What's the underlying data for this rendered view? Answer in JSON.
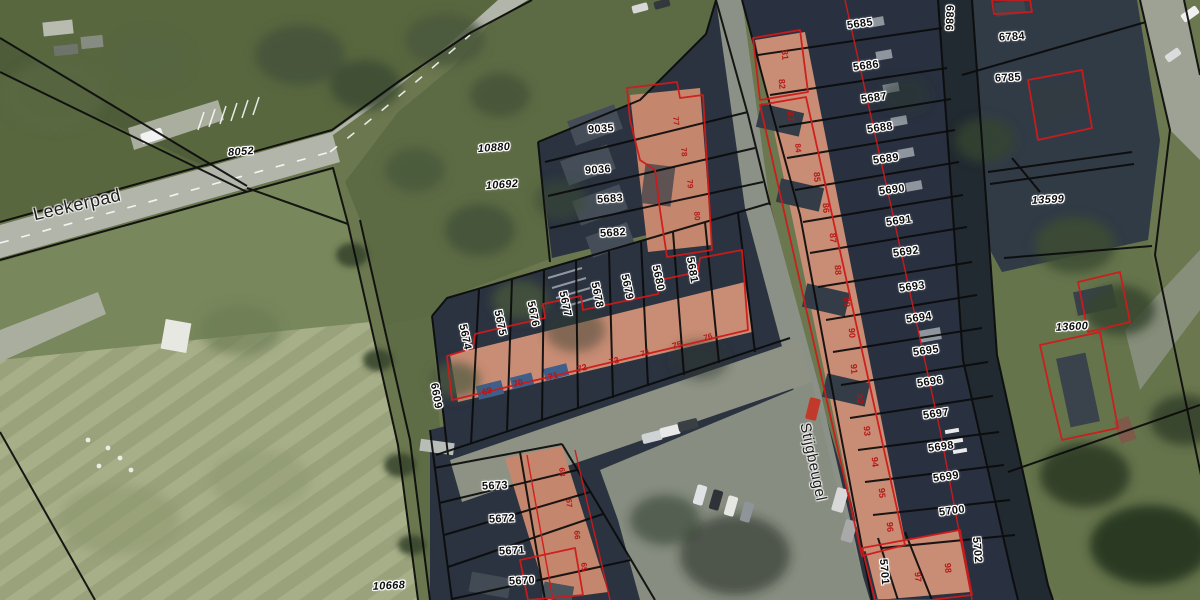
{
  "map": {
    "street_labels": [
      {
        "text": "Leekerpad",
        "x": 77,
        "y": 205,
        "rot": -13,
        "size": 18
      },
      {
        "text": "Stijgbeugel",
        "x": 813,
        "y": 462,
        "rot": 78,
        "size": 15
      }
    ],
    "parcel_labels": [
      {
        "text": "8052",
        "x": 241,
        "y": 152,
        "rot": -4,
        "italic": true
      },
      {
        "text": "10880",
        "x": 494,
        "y": 148,
        "rot": -4,
        "italic": true
      },
      {
        "text": "10692",
        "x": 502,
        "y": 185,
        "rot": -4,
        "italic": true
      },
      {
        "text": "10668",
        "x": 389,
        "y": 586,
        "rot": -3,
        "italic": true
      },
      {
        "text": "13599",
        "x": 1048,
        "y": 200,
        "rot": -3,
        "italic": true
      },
      {
        "text": "13600",
        "x": 1072,
        "y": 327,
        "rot": -3,
        "italic": true
      },
      {
        "text": "9035",
        "x": 601,
        "y": 129,
        "rot": -4
      },
      {
        "text": "9036",
        "x": 598,
        "y": 170,
        "rot": -4
      },
      {
        "text": "5683",
        "x": 610,
        "y": 199,
        "rot": -4
      },
      {
        "text": "5682",
        "x": 613,
        "y": 233,
        "rot": -4
      },
      {
        "text": "5685",
        "x": 860,
        "y": 24,
        "rot": -8
      },
      {
        "text": "5686",
        "x": 866,
        "y": 66,
        "rot": -8
      },
      {
        "text": "6886",
        "x": 949,
        "y": 18,
        "rot": 92
      },
      {
        "text": "6784",
        "x": 1012,
        "y": 37,
        "rot": -3
      },
      {
        "text": "6785",
        "x": 1008,
        "y": 78,
        "rot": -3
      },
      {
        "text": "5687",
        "x": 874,
        "y": 98,
        "rot": -8
      },
      {
        "text": "5688",
        "x": 880,
        "y": 128,
        "rot": -8
      },
      {
        "text": "5689",
        "x": 886,
        "y": 159,
        "rot": -8
      },
      {
        "text": "5690",
        "x": 892,
        "y": 190,
        "rot": -8
      },
      {
        "text": "5691",
        "x": 899,
        "y": 221,
        "rot": -8
      },
      {
        "text": "5692",
        "x": 906,
        "y": 252,
        "rot": -8
      },
      {
        "text": "5693",
        "x": 912,
        "y": 287,
        "rot": -8
      },
      {
        "text": "5694",
        "x": 919,
        "y": 318,
        "rot": -8
      },
      {
        "text": "5695",
        "x": 926,
        "y": 351,
        "rot": -8
      },
      {
        "text": "5696",
        "x": 930,
        "y": 382,
        "rot": -8
      },
      {
        "text": "5697",
        "x": 936,
        "y": 414,
        "rot": -8
      },
      {
        "text": "5698",
        "x": 941,
        "y": 447,
        "rot": -8
      },
      {
        "text": "5699",
        "x": 946,
        "y": 477,
        "rot": -8
      },
      {
        "text": "5700",
        "x": 952,
        "y": 511,
        "rot": -8
      },
      {
        "text": "5701",
        "x": 884,
        "y": 572,
        "rot": 85
      },
      {
        "text": "5702",
        "x": 977,
        "y": 550,
        "rot": 85
      },
      {
        "text": "5674",
        "x": 465,
        "y": 337,
        "rot": 78
      },
      {
        "text": "5675",
        "x": 500,
        "y": 323,
        "rot": 78
      },
      {
        "text": "5676",
        "x": 533,
        "y": 314,
        "rot": 78
      },
      {
        "text": "5677",
        "x": 565,
        "y": 304,
        "rot": 78
      },
      {
        "text": "5678",
        "x": 597,
        "y": 295,
        "rot": 78
      },
      {
        "text": "5679",
        "x": 627,
        "y": 287,
        "rot": 78
      },
      {
        "text": "5680",
        "x": 658,
        "y": 278,
        "rot": 78
      },
      {
        "text": "5681",
        "x": 692,
        "y": 270,
        "rot": 80
      },
      {
        "text": "6609",
        "x": 436,
        "y": 396,
        "rot": 80
      },
      {
        "text": "5673",
        "x": 495,
        "y": 486,
        "rot": -3
      },
      {
        "text": "5672",
        "x": 502,
        "y": 519,
        "rot": -3
      },
      {
        "text": "5671",
        "x": 512,
        "y": 551,
        "rot": -3
      },
      {
        "text": "5670",
        "x": 522,
        "y": 581,
        "rot": -3
      }
    ],
    "house_numbers": [
      {
        "text": "69",
        "x": 487,
        "y": 391,
        "rot": -15
      },
      {
        "text": "70",
        "x": 518,
        "y": 383,
        "rot": -15
      },
      {
        "text": "71",
        "x": 553,
        "y": 376,
        "rot": -15
      },
      {
        "text": "72",
        "x": 582,
        "y": 368,
        "rot": -15
      },
      {
        "text": "73",
        "x": 614,
        "y": 361,
        "rot": -15
      },
      {
        "text": "74",
        "x": 645,
        "y": 353,
        "rot": -15,
        "size": 8
      },
      {
        "text": "75",
        "x": 677,
        "y": 345,
        "rot": -15
      },
      {
        "text": "76",
        "x": 708,
        "y": 337,
        "rot": -15,
        "size": 8
      },
      {
        "text": "77",
        "x": 676,
        "y": 121,
        "rot": 85,
        "size": 8
      },
      {
        "text": "78",
        "x": 684,
        "y": 152,
        "rot": 85,
        "size": 8
      },
      {
        "text": "79",
        "x": 690,
        "y": 184,
        "rot": 85,
        "size": 8
      },
      {
        "text": "80",
        "x": 697,
        "y": 216,
        "rot": 85,
        "size": 8
      },
      {
        "text": "81",
        "x": 785,
        "y": 55,
        "rot": 85
      },
      {
        "text": "82",
        "x": 782,
        "y": 84,
        "rot": 85
      },
      {
        "text": "83",
        "x": 791,
        "y": 116,
        "rot": 85
      },
      {
        "text": "84",
        "x": 798,
        "y": 148,
        "rot": 85,
        "size": 8
      },
      {
        "text": "85",
        "x": 817,
        "y": 177,
        "rot": 85
      },
      {
        "text": "86",
        "x": 826,
        "y": 208,
        "rot": 85
      },
      {
        "text": "87",
        "x": 833,
        "y": 238,
        "rot": 85
      },
      {
        "text": "88",
        "x": 838,
        "y": 270,
        "rot": 85
      },
      {
        "text": "89",
        "x": 847,
        "y": 302,
        "rot": 85
      },
      {
        "text": "90",
        "x": 852,
        "y": 333,
        "rot": 85
      },
      {
        "text": "91",
        "x": 854,
        "y": 369,
        "rot": 85
      },
      {
        "text": "92",
        "x": 860,
        "y": 399,
        "rot": 85
      },
      {
        "text": "93",
        "x": 867,
        "y": 431,
        "rot": 85
      },
      {
        "text": "94",
        "x": 875,
        "y": 462,
        "rot": 85
      },
      {
        "text": "95",
        "x": 882,
        "y": 493,
        "rot": 85
      },
      {
        "text": "96",
        "x": 890,
        "y": 527,
        "rot": 85
      },
      {
        "text": "97",
        "x": 918,
        "y": 577,
        "rot": 85
      },
      {
        "text": "98",
        "x": 948,
        "y": 568,
        "rot": 85
      },
      {
        "text": "68",
        "x": 562,
        "y": 472,
        "rot": 85,
        "size": 8
      },
      {
        "text": "67",
        "x": 569,
        "y": 503,
        "rot": 85,
        "size": 8
      },
      {
        "text": "66",
        "x": 577,
        "y": 535,
        "rot": 85,
        "size": 8
      },
      {
        "text": "65",
        "x": 584,
        "y": 567,
        "rot": 85,
        "size": 8
      }
    ],
    "colors": {
      "parcel_boundary": "#0b0b0b",
      "building_outline": "#cf1b1b",
      "house_number": "#b51414",
      "label_halo": "#ffffff"
    }
  }
}
